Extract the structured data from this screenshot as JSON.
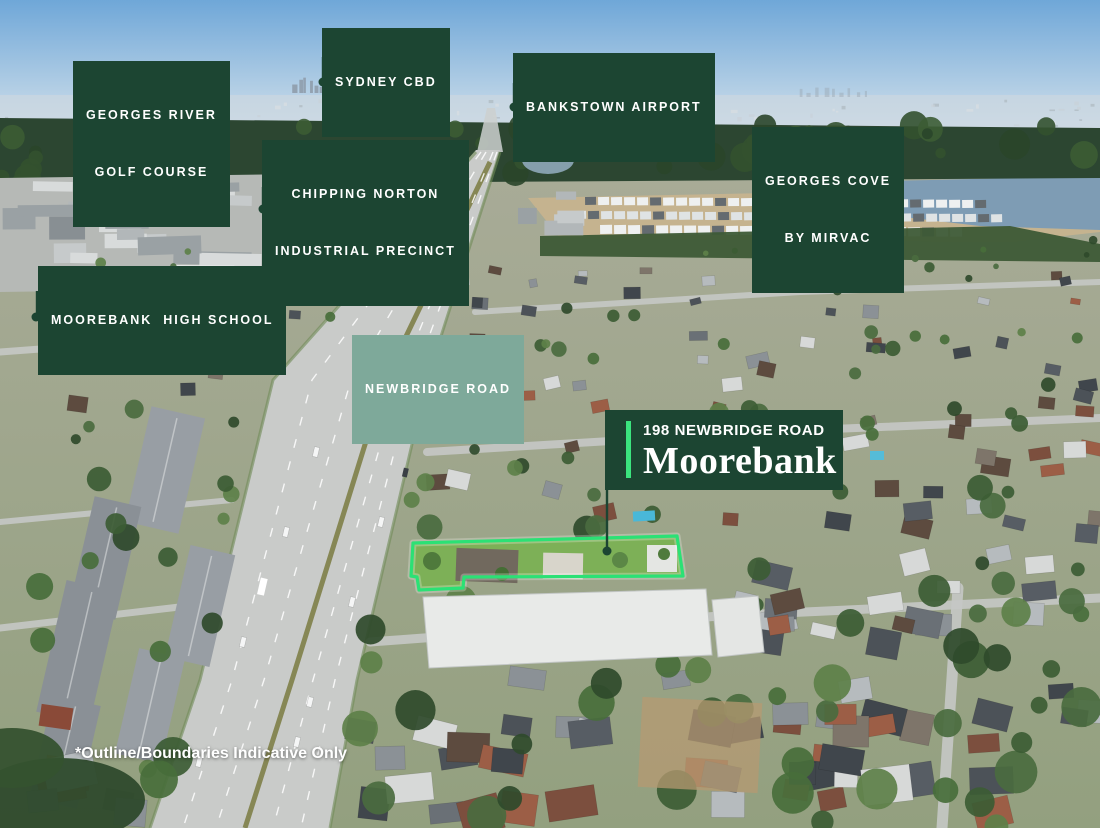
{
  "image_title": "Aerial location view - 198 Newbridge Road Moorebank",
  "callouts": {
    "sydney_cbd": {
      "line1": "SYDNEY CBD"
    },
    "georges_river": {
      "line1": "GEORGES RIVER",
      "line2": "GOLF COURSE"
    },
    "bankstown": {
      "line1": "BANKSTOWN AIRPORT"
    },
    "chipping_norton": {
      "line1": "CHIPPING NORTON",
      "line2": "INDUSTRIAL PRECINCT"
    },
    "georges_cove": {
      "line1": "GEORGES COVE",
      "line2": "BY MIRVAC"
    },
    "moorebank_hs": {
      "line1": "MOOREBANK  HIGH SCHOOL"
    },
    "newbridge_road": {
      "line1": "NEWBRIDGE ROAD"
    }
  },
  "property_label": {
    "address": "198 NEWBRIDGE ROAD",
    "suburb": "Moorebank"
  },
  "disclaimer": "*Outline/Boundaries Indicative Only",
  "colors": {
    "label_bg": "#1c4532",
    "label_text": "#ffffff",
    "road_label_bg": "#7ea99a",
    "accent_green": "#3be47e",
    "outline_green": "#2be175"
  }
}
